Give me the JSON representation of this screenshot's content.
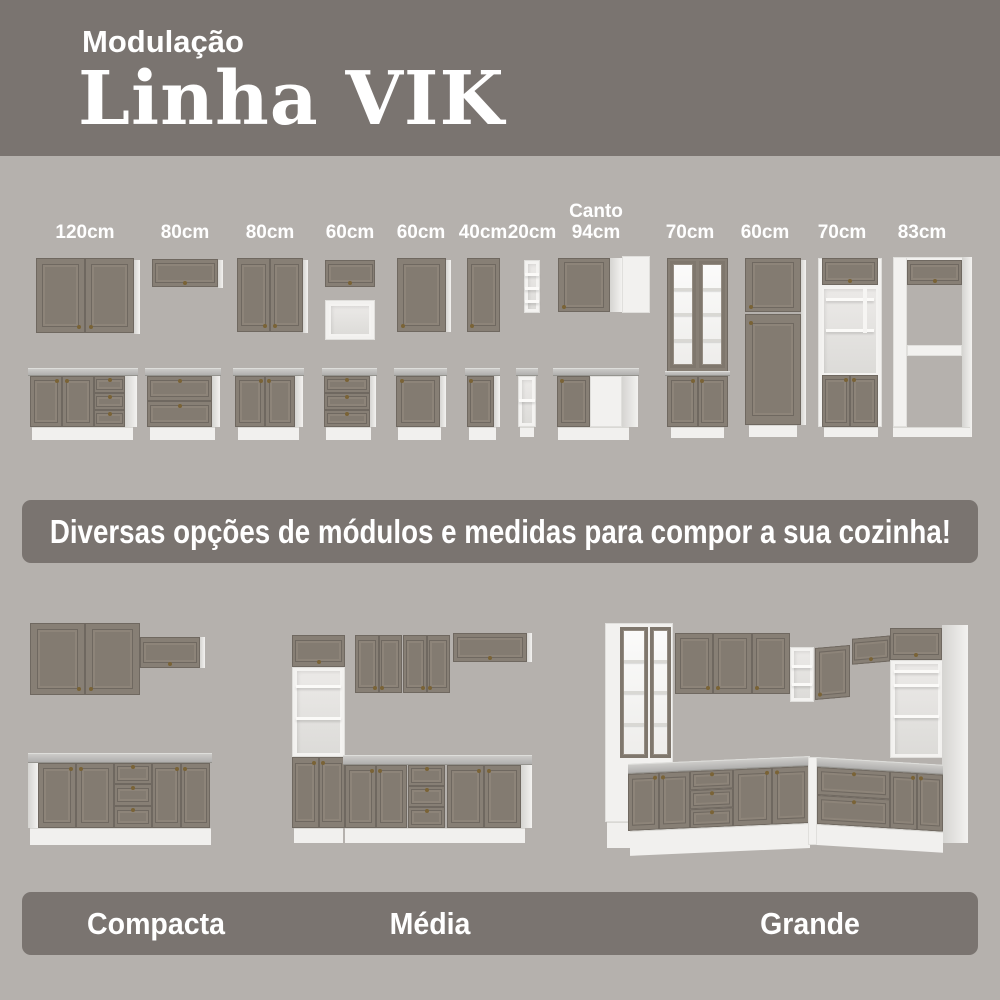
{
  "header": {
    "kicker": "Modulação",
    "title": "Linha VIK"
  },
  "labels_left": [
    "120cm",
    "80cm",
    "80cm",
    "60cm",
    "60cm",
    "40cm",
    "20cm"
  ],
  "canto_label": {
    "line1": "Canto",
    "line2": "94cm"
  },
  "labels_right": [
    "70cm",
    "60cm",
    "70cm",
    "83cm"
  ],
  "banner": {
    "text": "Diversas opções de módulos e medidas para compor a sua cozinha!"
  },
  "kitchen_labels": [
    "Compacta",
    "Média",
    "Grande"
  ],
  "colors": {
    "header_bg": "#7a7470",
    "body_bg": "#b5b1ad",
    "banner_bg": "#7a7470",
    "cabinet_face": "#877f75",
    "cabinet_outline": "#6f6860",
    "white_module": "#f2f1ef",
    "countertop": "#b7b6b4",
    "handle": "#7a6336",
    "text": "#ffffff"
  }
}
